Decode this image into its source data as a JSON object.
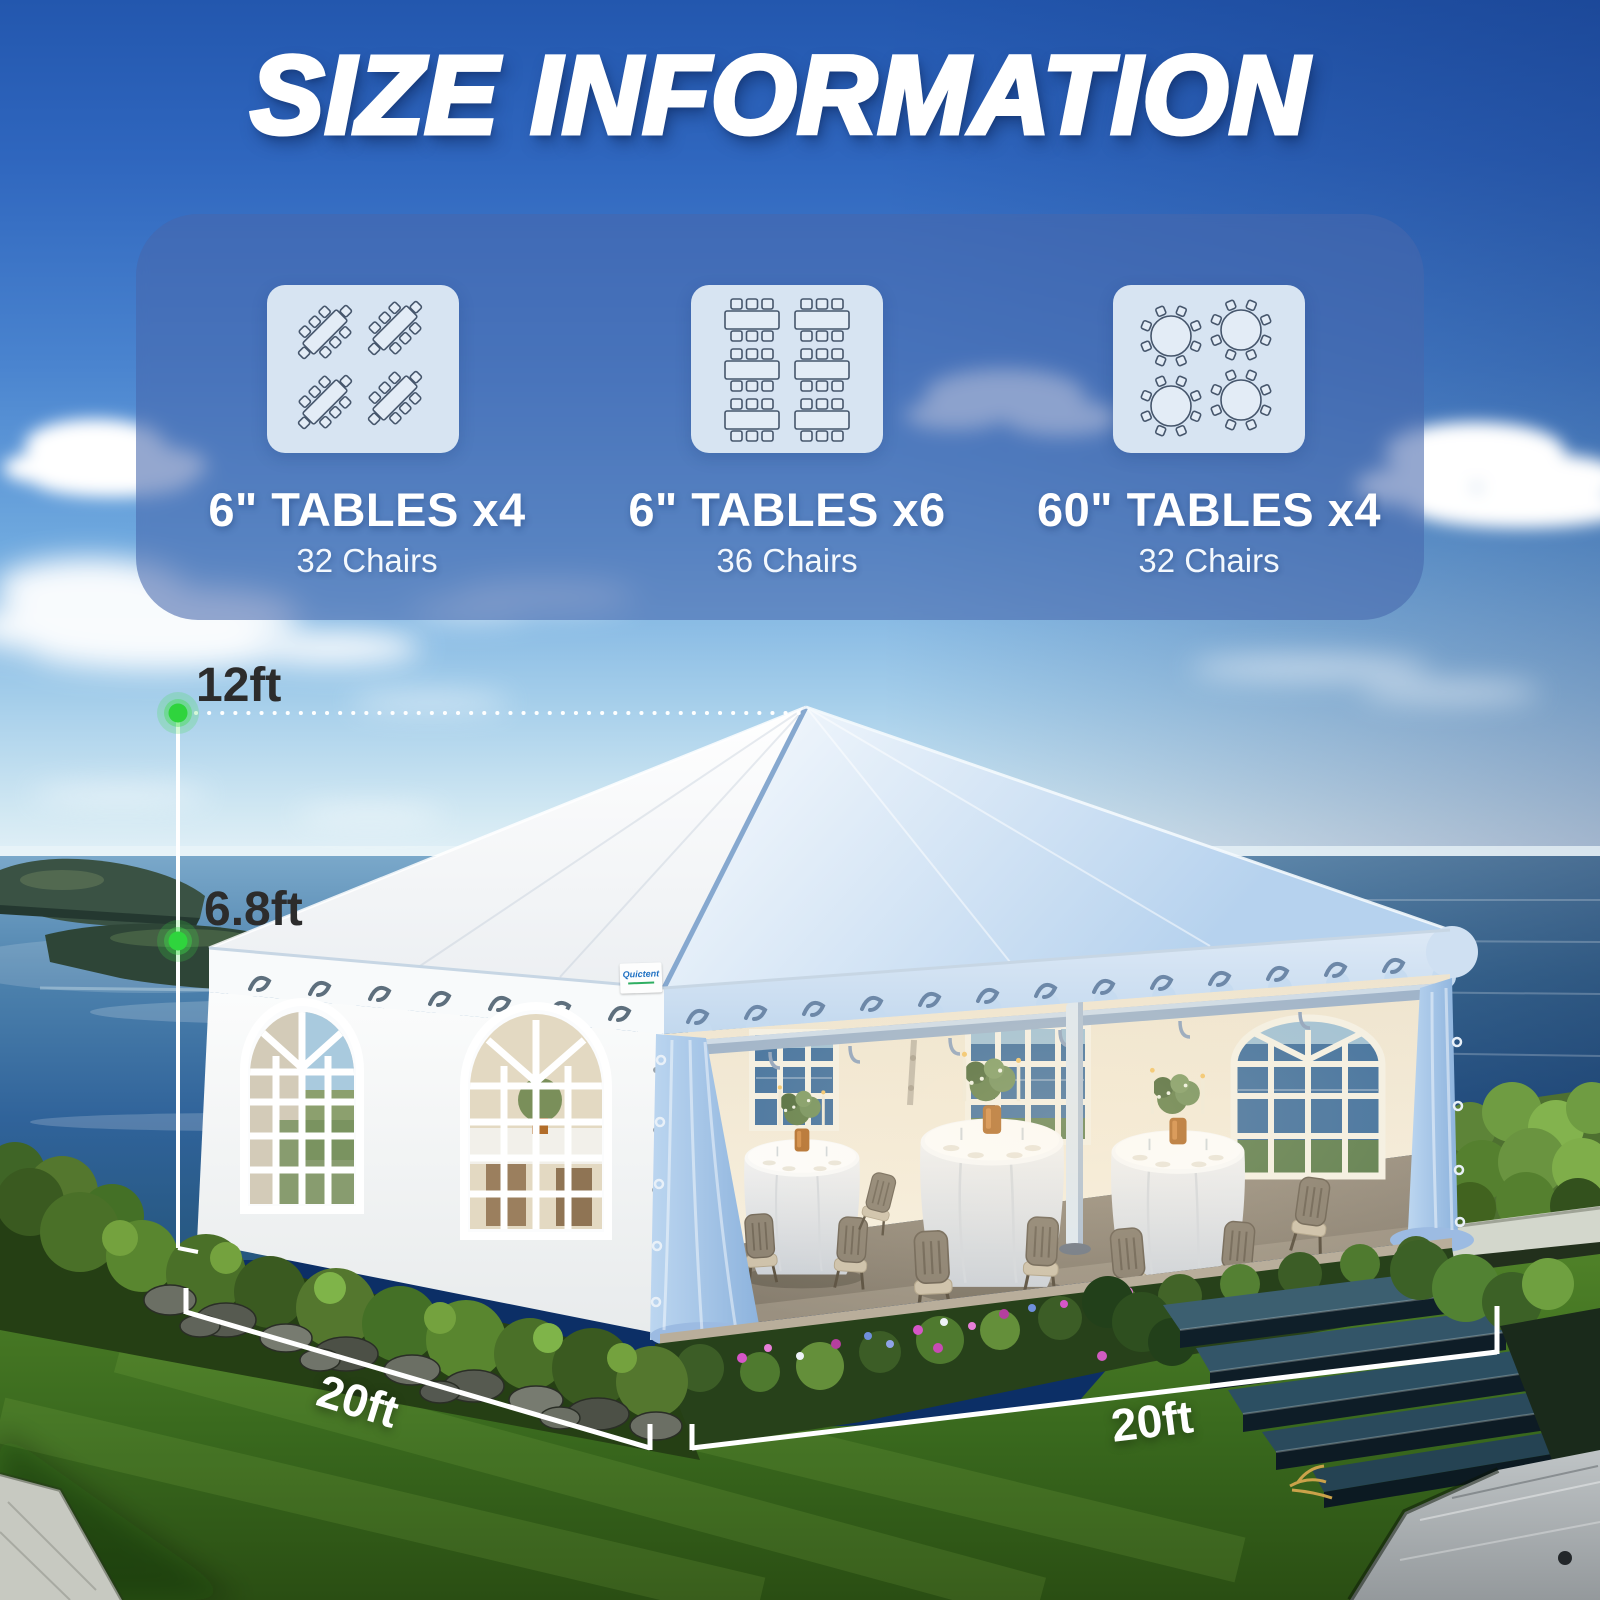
{
  "title": "SIZE INFORMATION",
  "capacity_panel": {
    "cards": [
      {
        "table_label": "6\" TABLES x4",
        "chairs_label": "32 Chairs",
        "table_count": 4,
        "chair_count": 32,
        "table_type": "rectangular-diagonal"
      },
      {
        "table_label": "6\" TABLES x6",
        "chairs_label": "36 Chairs",
        "table_count": 6,
        "chair_count": 36,
        "table_type": "rectangular-grid"
      },
      {
        "table_label": "60\" TABLES x4",
        "chairs_label": "32 Chairs",
        "table_count": 4,
        "chair_count": 32,
        "table_type": "round"
      }
    ]
  },
  "dimensions": {
    "peak_height": "12ft",
    "eave_height": "6.8ft",
    "side_depth": "20ft",
    "front_width": "20ft"
  },
  "tent": {
    "brand": "Quictent"
  },
  "colors": {
    "marker_green": "#2fd43d",
    "dimension_label_dark": "#2c2c2c",
    "dimension_label_light": "#ffffff",
    "title_text": "#ffffff"
  }
}
